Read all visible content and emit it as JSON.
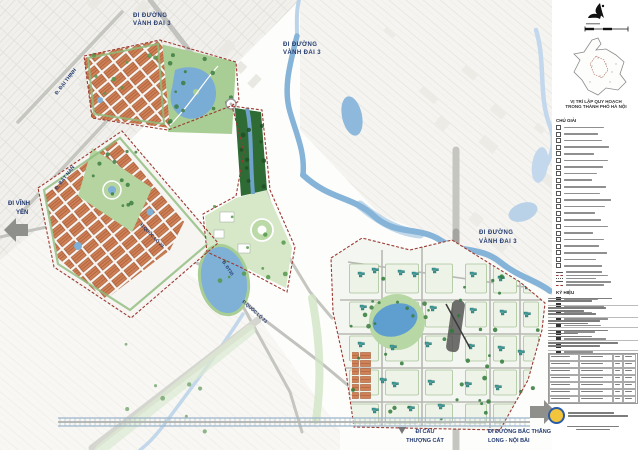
{
  "labels": {
    "vd3_nw_l1": "ĐI ĐƯỜNG",
    "vd3_nw_l2": "VÀNH ĐAI 3",
    "vd3_top_l1": "ĐI ĐƯỜNG",
    "vd3_top_l2": "VÀNH ĐAI 3",
    "vd3_right_l1": "ĐI ĐƯỜNG",
    "vd3_right_l2": "VÀNH ĐAI 3",
    "vinh_yen_l1": "ĐI VĨNH",
    "vinh_yen_l2": "YÊN",
    "dai_thinh": "Đ. ĐẠI THỊNH",
    "bat_nan": "Đ. BÁT NÀN",
    "ql23_a": "Đ.QUỐC LỘ 23",
    "ql23_b": "Đ.QUỐC LỘ 23",
    "dt35": "Đ. ĐT35",
    "thuong_cat_l1": "ĐI CẦU",
    "thuong_cat_l2": "THƯỢNG CÁT",
    "btl_l1": "ĐI ĐƯỜNG BẮC THĂNG",
    "btl_l2": "LONG - NỘI BÀI"
  },
  "panel": {
    "inset_caption_l1": "VỊ TRÍ LẬP QUY HOẠCH",
    "inset_caption_l2": "TRONG THÀNH PHỐ HÀ NỘI",
    "legend_title": "CHÚ GIẢI",
    "legend2_title": "KÝ HIỆU"
  },
  "legend": {
    "groups": [
      {
        "name": "areas",
        "symbol": "square",
        "rows": [
          40,
          34,
          38,
          45,
          30,
          44,
          39,
          33,
          28,
          42,
          36,
          47,
          41,
          31,
          37,
          44,
          29,
          40,
          35,
          43,
          32,
          38
        ]
      },
      {
        "name": "lines",
        "symbol": "line",
        "line_styles": [
          "solid",
          "dashed-red",
          "dotted",
          "solid",
          "dashed-red"
        ],
        "rows": [
          36,
          42,
          30,
          45,
          38
        ]
      },
      {
        "name": "marks",
        "symbol": "dot",
        "rows": [
          34,
          40,
          28,
          44,
          37,
          31,
          42,
          35,
          29
        ]
      }
    ]
  },
  "titleblock": {
    "sections": [
      [
        64,
        44
      ],
      [
        58,
        36,
        48
      ],
      [
        52,
        40
      ],
      [
        60,
        30,
        44
      ],
      [
        70,
        52
      ]
    ],
    "table": {
      "rows": 7
    },
    "footer": [
      [
        46,
        60
      ],
      [
        52,
        34
      ]
    ]
  },
  "colors": {
    "boundary": "#9b3a32",
    "water": "#86b3d8",
    "park_green": "#a9ce95",
    "dense_green": "#2e6b35",
    "residential_orange": "#cf8157",
    "building_teal": "#3f9b99",
    "road_gray": "#c6c6c1",
    "label_navy": "#233a70"
  }
}
